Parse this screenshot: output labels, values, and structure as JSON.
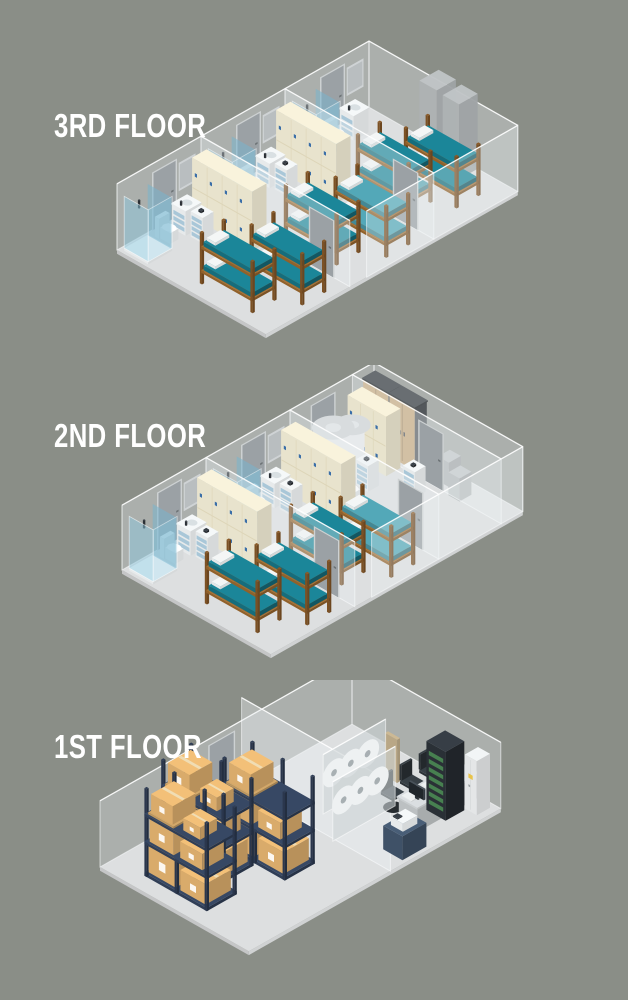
{
  "floors": [
    {
      "id": "floor-3",
      "label": "3RD FLOOR",
      "items": [
        "bunk-bed",
        "locker-cabinet",
        "shower-stall",
        "toilet",
        "sink-vanity",
        "supply-cart",
        "glass-wall",
        "door",
        "utility-shaft"
      ]
    },
    {
      "id": "floor-2",
      "label": "2ND FLOOR",
      "items": [
        "bunk-bed",
        "locker-cabinet",
        "shower-stall",
        "toilet",
        "sink-vanity",
        "supply-cart",
        "water-heater",
        "wardrobe-cabinet",
        "storage-cabinet",
        "glass-wall",
        "door"
      ]
    },
    {
      "id": "floor-1",
      "label": "1ST FLOOR",
      "items": [
        "pallet-rack",
        "cardboard-box",
        "office-desk",
        "computer-monitor",
        "keyboard",
        "office-chair",
        "server-rack",
        "copier",
        "electrical-cabinet",
        "porthole-partition",
        "glass-wall",
        "door"
      ]
    }
  ],
  "palette": {
    "background": "#8a8e87",
    "label_text": "#ffffff",
    "slab": "#dddfe0",
    "glass_fill": "rgba(233,238,240,0.35)",
    "glass_edge": "rgba(250,252,253,0.6)",
    "wood": "#9a672d",
    "wood_post": "#8a5a28",
    "mattress": "#1a8092",
    "mattress_alt": "#4fa0af",
    "pillow": "#f2f4f4",
    "locker": "#f2ecd6",
    "lock": "#3a6ea8",
    "drawer_blue": "#a9c7d8",
    "door": "#9ba1a5",
    "door_frame": "#cdd1d2",
    "door_handle": "#6d7376",
    "shower_glass": "rgba(141,199,221,0.5)",
    "fixture_white": "#eef1f2",
    "gray": "#b9bdbf",
    "shaft": "#b3b7b9",
    "wardrobe_tan": "#c7a87c",
    "wardrobe_frame": "#5f6468",
    "rack_navy": "#32415b",
    "box_tan": "#d9ab6b",
    "pallet_tan": "#c9a064",
    "box_tape": "#f0ddb4",
    "box_label": "rgba(255,255,255,0.9)",
    "desk": "#c6cacc",
    "screen": "#20262b",
    "chair": "#31383d",
    "copier": "#42556c",
    "cabinet": "#edf0f1",
    "server_dark": "#2a3036",
    "server_green": "#478050",
    "accent_yellow": "#e8c34a",
    "porthole_wall": "rgba(205,211,214,0.6)",
    "porthole": "rgba(160,168,172,0.85)",
    "heater": "#e7eaec",
    "window_frame": "#cfd3d5",
    "window_inner": "#b9bec0",
    "seam_cream": "#ddd5b8"
  }
}
